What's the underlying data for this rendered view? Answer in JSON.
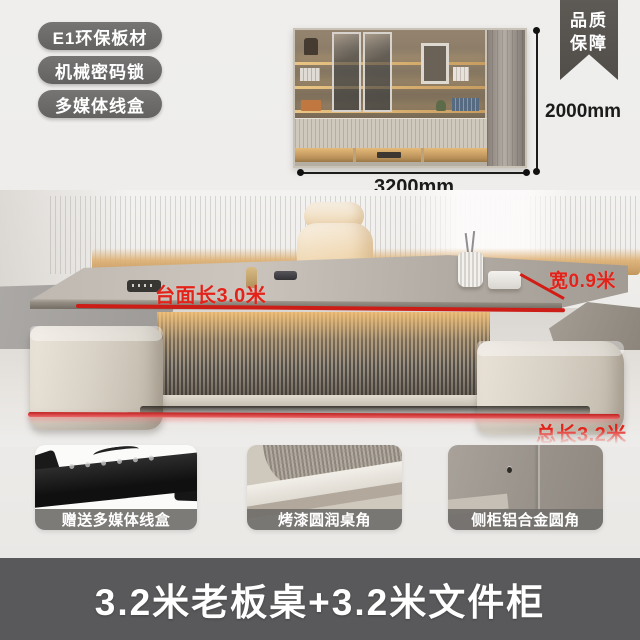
{
  "badges": {
    "items": [
      {
        "label": "E1环保板材"
      },
      {
        "label": "机械密码锁"
      },
      {
        "label": "多媒体线盒"
      }
    ]
  },
  "ribbon": {
    "line1": "品质",
    "line2": "保障"
  },
  "cabinet": {
    "height_label": "2000mm",
    "width_label": "3200mm"
  },
  "annotations": {
    "desktop_length": "台面长3.0米",
    "width": "宽0.9米",
    "total_length": "总长3.2米"
  },
  "features": [
    {
      "label": "赠送多媒体线盒"
    },
    {
      "label": "烤漆圆润桌角"
    },
    {
      "label": "侧柜铝合金圆角"
    }
  ],
  "banner": {
    "title": "3.2米老板桌+3.2米文件柜"
  },
  "colors": {
    "accent_red": "#e3221a",
    "badge_gray": "#6c6b69",
    "ribbon_gray": "#57534f",
    "banner_gray": "#59585a",
    "label_bar_gray": "#72706d",
    "led_warm": "#deb073",
    "dimension_ink": "#1c1c1c"
  }
}
